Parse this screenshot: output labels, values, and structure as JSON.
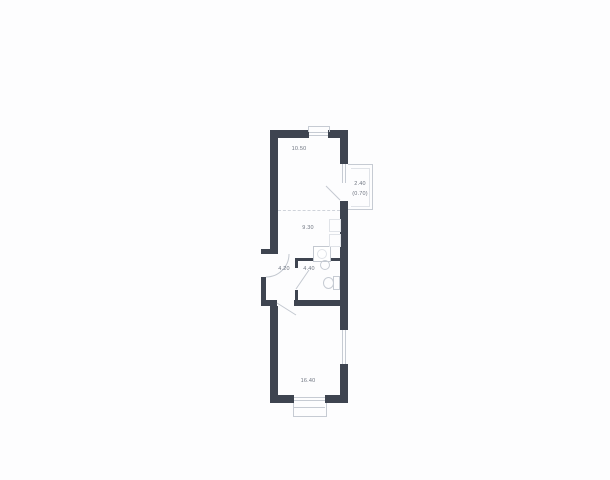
{
  "floorplan": {
    "type": "apartment-floor-plan",
    "colors": {
      "wall": "#3e4450",
      "outline": "#c6cbd3",
      "text": "#6e7480",
      "background": "#fdfdfe"
    },
    "rooms": [
      {
        "id": "living-upper",
        "area_label": "10.50"
      },
      {
        "id": "kitchen-lower",
        "area_label": "9.30"
      },
      {
        "id": "hallway",
        "area_label": "4.20"
      },
      {
        "id": "bathroom",
        "area_label": "4.40"
      },
      {
        "id": "room-main",
        "area_label": "16.40"
      },
      {
        "id": "balcony",
        "area_label": "2.40",
        "area_label_secondary": "(0.70)"
      }
    ]
  }
}
